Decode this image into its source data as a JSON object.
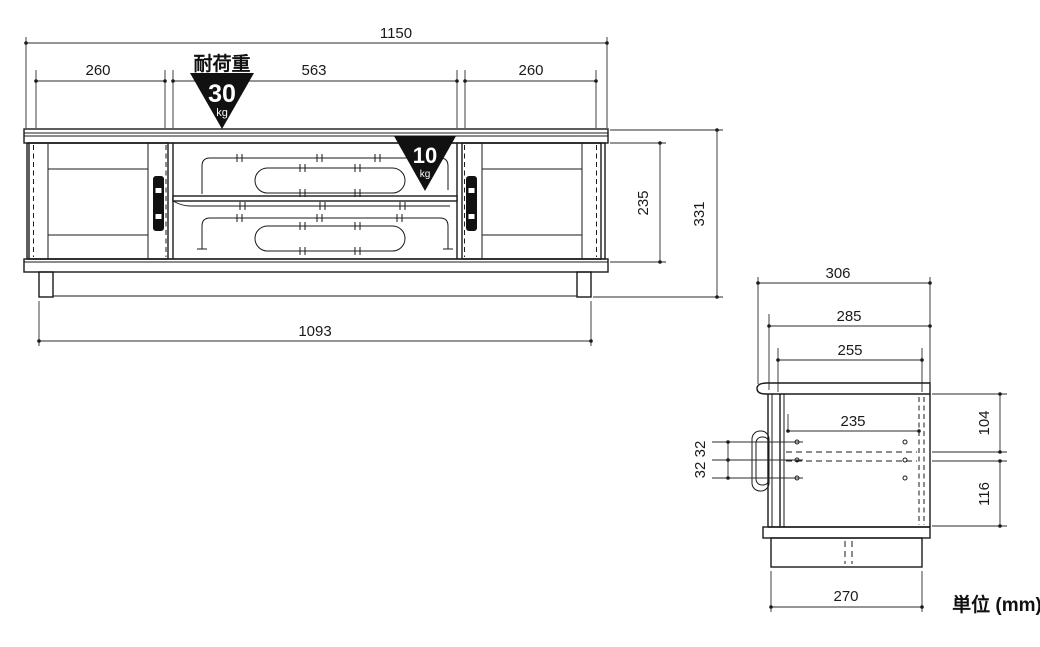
{
  "drawing": {
    "unit_note": "単位 (mm)",
    "front_view": {
      "load_label": "耐荷重",
      "load_top": {
        "value": "30",
        "unit": "kg"
      },
      "load_shelf": {
        "value": "10",
        "unit": "kg"
      },
      "dims": {
        "overall_width": "1150",
        "left_door_width": "260",
        "center_width": "563",
        "right_door_width": "260",
        "inner_height": "235",
        "overall_height": "331",
        "base_width": "1093"
      }
    },
    "side_view": {
      "dims": {
        "overall_depth": "306",
        "body_depth": "285",
        "inner_depth": "255",
        "shelf_depth": "235",
        "upper_inner_height": "104",
        "lower_inner_height": "116",
        "hole_pitch_upper": "32",
        "hole_pitch_lower": "32",
        "base_depth": "270"
      }
    },
    "colors": {
      "line": "#1a1a1a",
      "warning_fill": "#111111"
    }
  }
}
